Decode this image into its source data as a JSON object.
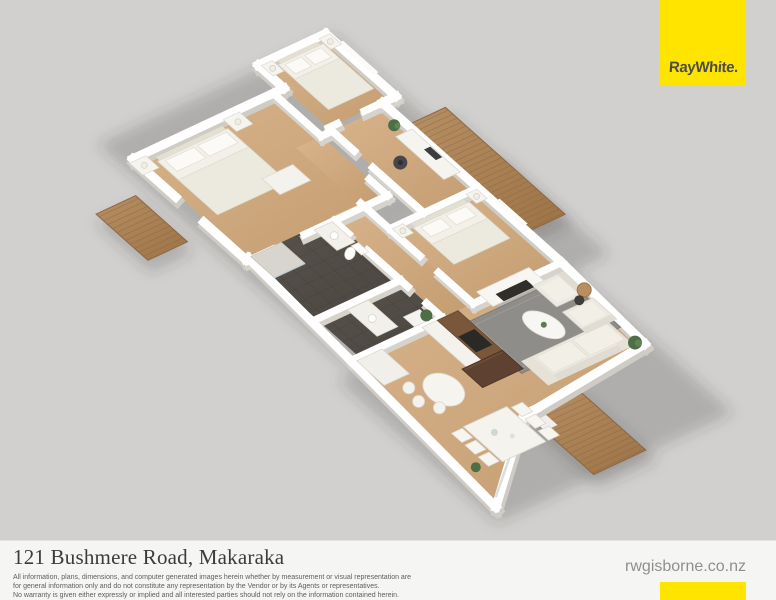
{
  "brand": {
    "name": "RayWhite."
  },
  "footer": {
    "address": "121 Bushmere Road, Makaraka",
    "disclaimer_lines": [
      "All information, plans, dimensions, and computer generated images herein whether by measurement or visual representation are",
      "for general information only and do not constitute any representation by the Vendor or by its Agents or representatives.",
      "No warranty is given either expressly or implied and all interested parties should not rely on the information contained herein."
    ],
    "website": "rwgisborne.co.nz"
  },
  "palette": {
    "brand-yellow": "#ffe400",
    "page-bg": "#d1d0ce",
    "footer-bg": "#f5f5f3",
    "wall": "#ffffff",
    "wood-light": "#d8b48c",
    "wood-dark": "#c49c70",
    "deck-light": "#b68f63",
    "deck-dark": "#9c7347",
    "tile-light": "#58534c",
    "tile-dark": "#4b4640",
    "rug": "#8f8d89"
  },
  "floor_plan": {
    "style": "3d-isometric-render",
    "rooms": [
      "master-bedroom",
      "bedroom-2",
      "bedroom-3",
      "office",
      "bathroom",
      "ensuite",
      "hallway",
      "kitchen",
      "dining",
      "living",
      "deck-top",
      "deck-small",
      "deck-rear"
    ]
  }
}
